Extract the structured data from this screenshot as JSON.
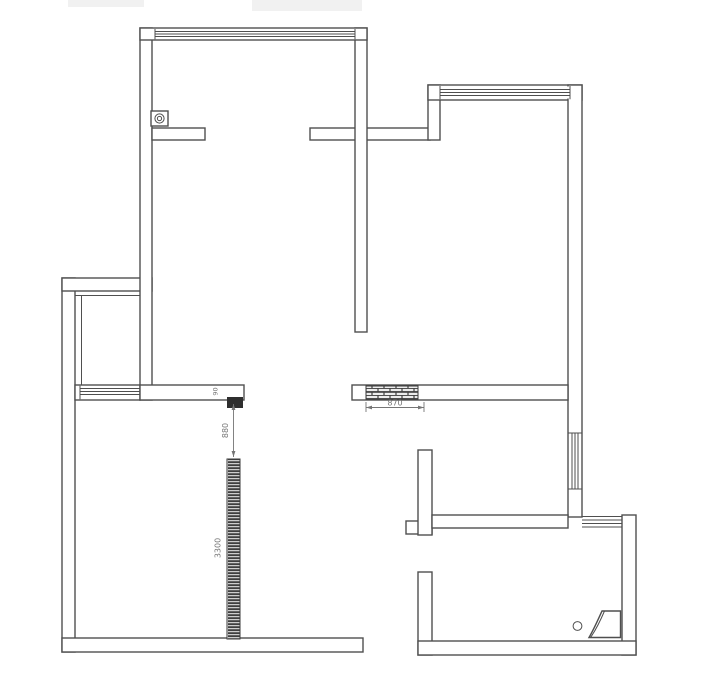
{
  "page": {
    "background": "#ffffff"
  },
  "plan": {
    "colors": {
      "wall_line": "#4f4f4f",
      "wall_fill": "#ffffff",
      "hatch_line": "#3a3a3a",
      "hatch_dark": "#3f3f3f",
      "brick_light": "#ededed",
      "block_fill": "#2e2e2e",
      "dim_color": "#757575"
    },
    "dimensions": {
      "brick_infill_width": "870",
      "opening_width": "880",
      "partition_length": "3300",
      "wall_end_width": "90"
    },
    "symbols": {
      "column": "column-with-pipe",
      "corner": "corner-fixture",
      "windows": "window-4-line",
      "brick": "brick-infill-hatch",
      "partition": "partition-hatch-strip"
    }
  }
}
